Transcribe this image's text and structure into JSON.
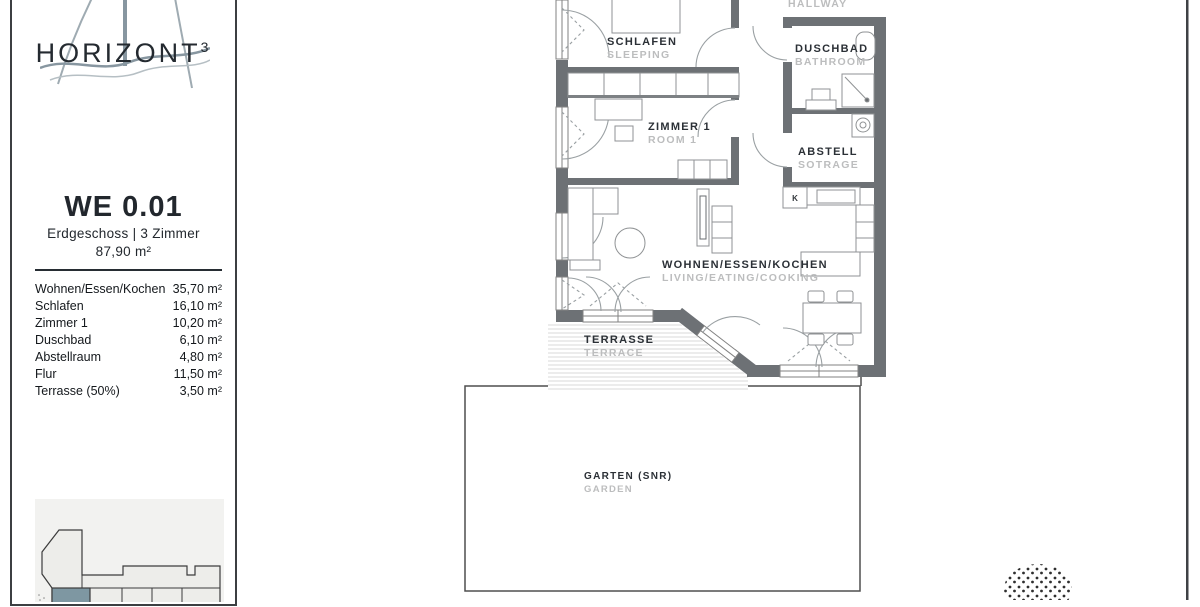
{
  "branding": {
    "logo_text": "HORIZONT",
    "logo_exponent": "3"
  },
  "unit": {
    "id": "WE 0.01",
    "subtitle": "Erdgeschoss | 3 Zimmer",
    "total_area": "87,90 m²",
    "rooms": [
      {
        "label": "Wohnen/Essen/Kochen",
        "area": "35,70 m²"
      },
      {
        "label": "Schlafen",
        "area": "16,10 m²"
      },
      {
        "label": "Zimmer 1",
        "area": "10,20 m²"
      },
      {
        "label": "Duschbad",
        "area": "6,10 m²"
      },
      {
        "label": "Abstellraum",
        "area": "4,80 m²"
      },
      {
        "label": "Flur",
        "area": "11,50 m²"
      },
      {
        "label": "Terrasse (50%)",
        "area": "3,50 m²"
      }
    ]
  },
  "floorplan": {
    "hallway": {
      "en": "HALLWAY"
    },
    "schlafen": {
      "de": "SCHLAFEN",
      "en": "SLEEPING"
    },
    "duschbad": {
      "de": "DUSCHBAD",
      "en": "BATHROOM"
    },
    "zimmer1": {
      "de": "ZIMMER 1",
      "en": "ROOM 1"
    },
    "abstell": {
      "de": "ABSTELL",
      "en": "SOTRAGE"
    },
    "wohnen": {
      "de": "WOHNEN/ESSEN/KOCHEN",
      "en": "LIVING/EATING/COOKING"
    },
    "terrasse": {
      "de": "TERRASSE",
      "en": "TERRACE"
    },
    "garten": {
      "de": "GARTEN (SNR)",
      "en": "GARDEN"
    },
    "kitchen_marker": "K"
  },
  "colors": {
    "wall": "#6d7175",
    "label_dark": "#2b3036",
    "label_light": "#bcbdbe",
    "highlighted_unit": "#7e97a2",
    "logo_accent": "#8796a0"
  }
}
